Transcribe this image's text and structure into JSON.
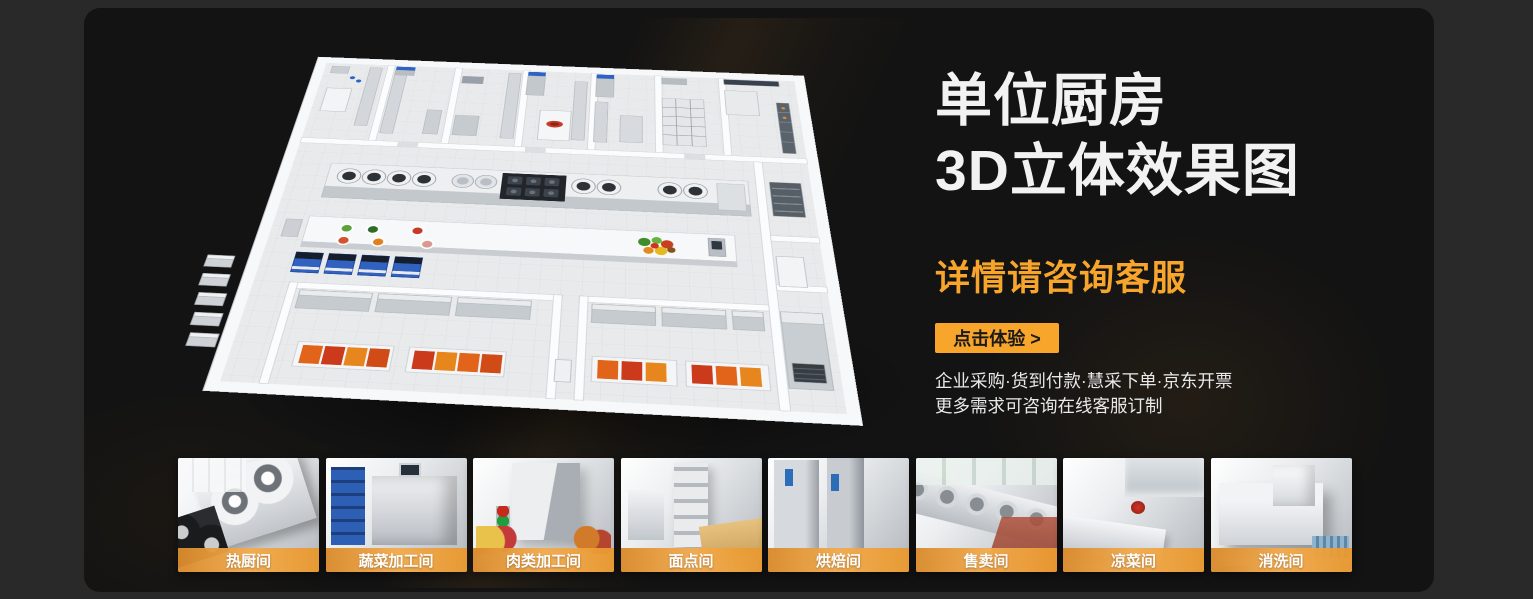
{
  "theme": {
    "outer_bg": "#292929",
    "panel_bg": "#131313",
    "accent": "#F7A52B",
    "heading": "#F2F2F2",
    "body_text": "#E9E9E9",
    "cta_text": "#1A1A1A",
    "label_a": "#D98A2B",
    "label_b": "#F3AB4E",
    "label_c": "#E9992F"
  },
  "hero": {
    "title_line1": "单位厨房",
    "title_line2": "3D立体效果图",
    "subtitle": "详情请咨询客服",
    "cta_label": "点击体验 >",
    "feature_line1": "企业采购·货到付款·慧采下单·京东开票",
    "feature_line2": "更多需求可咨询在线客服订制"
  },
  "thumbnails": [
    {
      "label": "热厨间"
    },
    {
      "label": "蔬菜加工间"
    },
    {
      "label": "肉类加工间"
    },
    {
      "label": "面点间"
    },
    {
      "label": "烘焙间"
    },
    {
      "label": "售卖间"
    },
    {
      "label": "凉菜间"
    },
    {
      "label": "消洗间"
    }
  ]
}
